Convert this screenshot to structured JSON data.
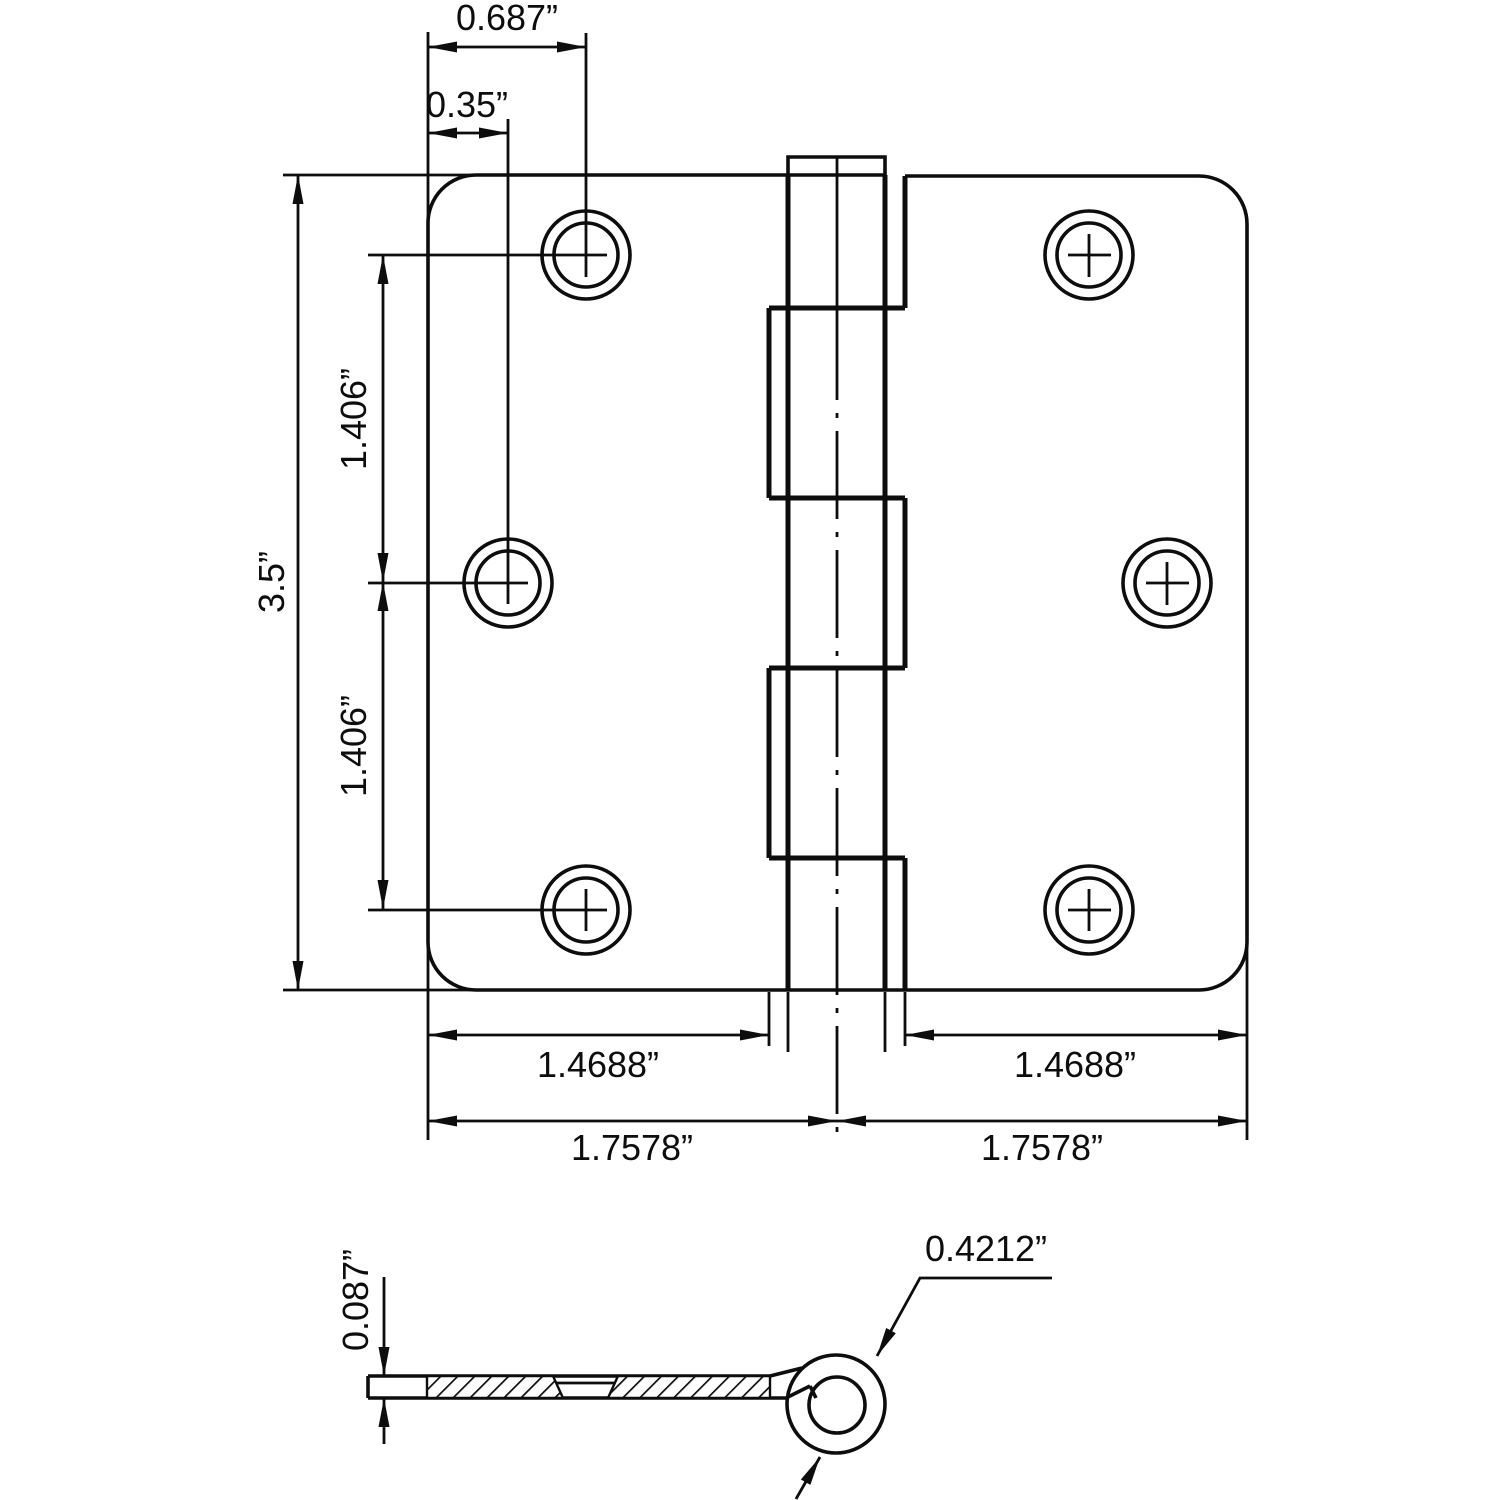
{
  "front_view": {
    "dim_hole_top_offset": "0.687”",
    "dim_hole_mid_offset": "0.35”",
    "dim_leaf_height": "3.5”",
    "dim_hole_spacing_upper": "1.406”",
    "dim_hole_spacing_lower": "1.406”",
    "dim_leaf_width_left": "1.4688”",
    "dim_leaf_width_right": "1.4688”",
    "dim_center_to_edge_left": "1.7578”",
    "dim_center_to_edge_right": "1.7578”"
  },
  "section_view": {
    "dim_leaf_thickness": "0.087”",
    "dim_knuckle_diameter": "0.4212”"
  }
}
